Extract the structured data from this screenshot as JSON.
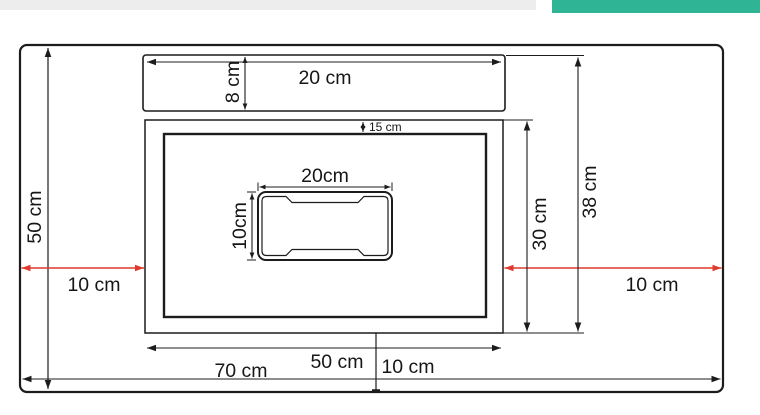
{
  "top_bars": {
    "gray_color": "#ededed",
    "teal_color": "#2fb596"
  },
  "diagram": {
    "colors": {
      "line": "#1c1c1c",
      "highlight_red": "#e03a2f"
    },
    "labels": {
      "top_strip_width": "20 cm",
      "top_strip_height": "8 cm",
      "top_inset": "15 cm",
      "basin_width": "20cm",
      "basin_height": "10cm",
      "left_height": "50 cm",
      "left_gap": "10 cm",
      "right_gap": "10 cm",
      "inner_height": "30 cm",
      "overall_inner_height": "38 cm",
      "bottom_left_width": "50 cm",
      "bottom_right_width": "10 cm",
      "bottom_total_width": "70 cm"
    }
  }
}
